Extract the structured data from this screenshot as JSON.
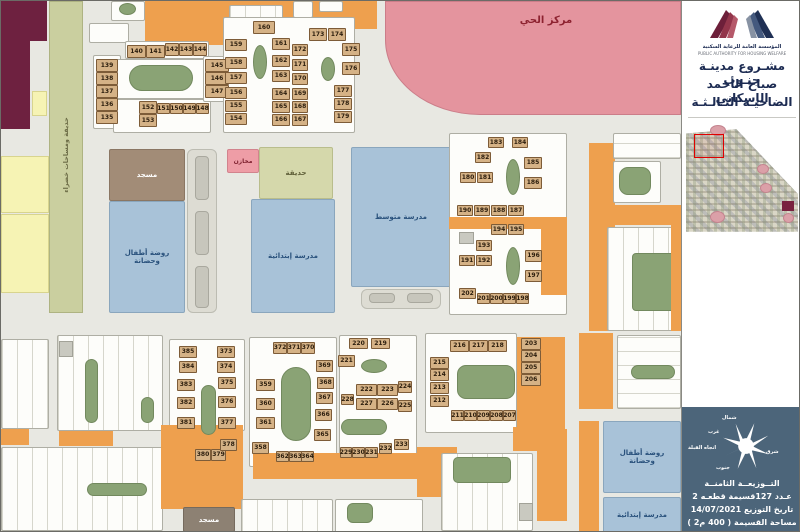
{
  "sidebar": {
    "org_name_ar": "المؤسسة العامة للرعاية السكنية",
    "org_name_en": "PUBLIC AUTHORITY FOR HOUSING WELFARE",
    "title_line1": "مشـروع مدينـة جنـوب",
    "title_line2": "صباح الأحمد الإسكاني",
    "title_line3": "الضاحيـة الثـالـثـة",
    "compass": {
      "north": "شمال",
      "west": "غرب",
      "east": "شرق",
      "south": "جنوب",
      "qibla": "اتجاه القبلة"
    },
    "info_lines": [
      "التــوزيعــة الثامنــة",
      "عـدد 127قسيمة قطعـه 2",
      "تاريخ التوزيع 14/07/2021",
      "مساحة القسيمة ( 400 م2 )"
    ]
  },
  "map": {
    "labels": {
      "neighborhood_center": "مركز الحي",
      "mosque": "مسجد",
      "kindergarten": "روضة أطفال وحضانة",
      "elementary_school": "مدرسة إبتدائية",
      "middle_school": "مدرسة متوسط",
      "stores": "مخازن",
      "park": "حديقة",
      "green_spaces": "حديقة ومساحات خضراء"
    },
    "plots": [
      [
        139,
        95,
        58,
        22,
        13
      ],
      [
        138,
        95,
        71,
        22,
        13
      ],
      [
        137,
        95,
        84,
        22,
        13
      ],
      [
        136,
        95,
        97,
        22,
        13
      ],
      [
        135,
        95,
        110,
        22,
        13
      ],
      [
        140,
        126,
        44,
        19,
        13
      ],
      [
        141,
        145,
        44,
        19,
        13
      ],
      [
        142,
        164,
        42,
        14,
        13
      ],
      [
        143,
        178,
        42,
        14,
        13
      ],
      [
        144,
        192,
        42,
        14,
        13
      ],
      [
        145,
        204,
        58,
        24,
        13
      ],
      [
        146,
        204,
        71,
        24,
        13
      ],
      [
        147,
        204,
        84,
        24,
        13
      ],
      [
        152,
        138,
        100,
        18,
        13
      ],
      [
        151,
        156,
        102,
        13,
        11
      ],
      [
        150,
        169,
        102,
        13,
        11
      ],
      [
        149,
        182,
        102,
        13,
        11
      ],
      [
        148,
        195,
        102,
        13,
        11
      ],
      [
        153,
        138,
        113,
        18,
        13
      ],
      [
        160,
        252,
        20,
        22,
        13
      ],
      [
        159,
        224,
        38,
        22,
        12
      ],
      [
        158,
        224,
        56,
        22,
        12
      ],
      [
        157,
        224,
        71,
        22,
        12
      ],
      [
        156,
        224,
        86,
        22,
        12
      ],
      [
        155,
        224,
        99,
        22,
        12
      ],
      [
        154,
        224,
        112,
        22,
        12
      ],
      [
        161,
        271,
        37,
        18,
        12
      ],
      [
        162,
        271,
        54,
        18,
        12
      ],
      [
        163,
        271,
        69,
        18,
        12
      ],
      [
        164,
        271,
        87,
        18,
        12
      ],
      [
        165,
        271,
        100,
        18,
        12
      ],
      [
        166,
        271,
        113,
        18,
        12
      ],
      [
        172,
        291,
        43,
        16,
        12
      ],
      [
        171,
        291,
        58,
        16,
        12
      ],
      [
        170,
        291,
        72,
        16,
        12
      ],
      [
        169,
        291,
        87,
        16,
        12
      ],
      [
        168,
        291,
        100,
        16,
        12
      ],
      [
        167,
        291,
        113,
        16,
        12
      ],
      [
        173,
        308,
        27,
        18,
        13
      ],
      [
        174,
        327,
        27,
        18,
        13
      ],
      [
        175,
        341,
        42,
        18,
        13
      ],
      [
        176,
        341,
        61,
        18,
        13
      ],
      [
        177,
        333,
        84,
        18,
        12
      ],
      [
        178,
        333,
        97,
        18,
        12
      ],
      [
        179,
        333,
        110,
        18,
        12
      ],
      [
        183,
        487,
        136,
        16,
        11
      ],
      [
        184,
        511,
        136,
        16,
        11
      ],
      [
        182,
        474,
        151,
        16,
        11
      ],
      [
        185,
        523,
        156,
        18,
        12
      ],
      [
        186,
        523,
        176,
        18,
        12
      ],
      [
        180,
        459,
        171,
        16,
        11
      ],
      [
        181,
        476,
        171,
        16,
        11
      ],
      [
        190,
        456,
        204,
        16,
        11
      ],
      [
        189,
        473,
        204,
        16,
        11
      ],
      [
        188,
        490,
        204,
        16,
        11
      ],
      [
        187,
        507,
        204,
        16,
        11
      ],
      [
        194,
        490,
        223,
        16,
        11
      ],
      [
        195,
        507,
        223,
        16,
        11
      ],
      [
        193,
        475,
        239,
        16,
        11
      ],
      [
        191,
        458,
        254,
        16,
        11
      ],
      [
        192,
        475,
        254,
        16,
        11
      ],
      [
        196,
        524,
        249,
        17,
        12
      ],
      [
        197,
        524,
        269,
        17,
        12
      ],
      [
        202,
        458,
        287,
        17,
        11
      ],
      [
        201,
        476,
        292,
        13,
        11
      ],
      [
        200,
        489,
        292,
        13,
        11
      ],
      [
        199,
        502,
        292,
        13,
        11
      ],
      [
        198,
        515,
        292,
        13,
        11
      ],
      [
        203,
        520,
        337,
        20,
        12
      ],
      [
        204,
        520,
        349,
        20,
        12
      ],
      [
        205,
        520,
        361,
        20,
        12
      ],
      [
        206,
        520,
        373,
        20,
        12
      ],
      [
        216,
        449,
        339,
        19,
        12
      ],
      [
        217,
        468,
        339,
        19,
        12
      ],
      [
        218,
        487,
        339,
        19,
        12
      ],
      [
        215,
        429,
        356,
        19,
        12
      ],
      [
        214,
        429,
        368,
        19,
        12
      ],
      [
        213,
        429,
        381,
        19,
        12
      ],
      [
        212,
        429,
        394,
        19,
        12
      ],
      [
        211,
        450,
        409,
        13,
        11
      ],
      [
        210,
        463,
        409,
        13,
        11
      ],
      [
        209,
        476,
        409,
        13,
        11
      ],
      [
        208,
        489,
        409,
        13,
        11
      ],
      [
        207,
        502,
        409,
        13,
        11
      ],
      [
        220,
        348,
        337,
        19,
        11
      ],
      [
        219,
        370,
        337,
        19,
        11
      ],
      [
        221,
        337,
        354,
        17,
        12
      ],
      [
        222,
        355,
        383,
        21,
        12
      ],
      [
        223,
        376,
        383,
        21,
        12
      ],
      [
        224,
        397,
        380,
        14,
        12
      ],
      [
        228,
        340,
        393,
        13,
        11
      ],
      [
        227,
        355,
        397,
        21,
        12
      ],
      [
        226,
        376,
        397,
        21,
        12
      ],
      [
        225,
        397,
        399,
        14,
        12
      ],
      [
        229,
        339,
        446,
        12,
        11
      ],
      [
        230,
        351,
        446,
        13,
        11
      ],
      [
        231,
        364,
        446,
        13,
        11
      ],
      [
        232,
        378,
        442,
        13,
        11
      ],
      [
        233,
        393,
        438,
        15,
        11
      ],
      [
        372,
        272,
        341,
        14,
        12
      ],
      [
        371,
        286,
        341,
        14,
        12
      ],
      [
        370,
        300,
        341,
        14,
        12
      ],
      [
        369,
        315,
        359,
        17,
        12
      ],
      [
        368,
        316,
        376,
        17,
        12
      ],
      [
        367,
        315,
        391,
        17,
        12
      ],
      [
        366,
        314,
        408,
        17,
        12
      ],
      [
        365,
        313,
        428,
        17,
        12
      ],
      [
        359,
        255,
        378,
        19,
        12
      ],
      [
        360,
        255,
        397,
        19,
        12
      ],
      [
        361,
        255,
        416,
        19,
        12
      ],
      [
        358,
        251,
        441,
        17,
        12
      ],
      [
        362,
        275,
        450,
        13,
        11
      ],
      [
        363,
        288,
        450,
        13,
        11
      ],
      [
        364,
        300,
        450,
        13,
        11
      ],
      [
        385,
        178,
        345,
        18,
        12
      ],
      [
        384,
        178,
        360,
        18,
        12
      ],
      [
        383,
        176,
        378,
        18,
        12
      ],
      [
        382,
        176,
        396,
        18,
        12
      ],
      [
        381,
        176,
        416,
        18,
        12
      ],
      [
        380,
        194,
        448,
        16,
        12
      ],
      [
        379,
        210,
        448,
        15,
        12
      ],
      [
        373,
        216,
        345,
        18,
        12
      ],
      [
        374,
        216,
        360,
        18,
        12
      ],
      [
        375,
        217,
        376,
        18,
        12
      ],
      [
        376,
        217,
        395,
        18,
        12
      ],
      [
        377,
        217,
        416,
        18,
        12
      ],
      [
        378,
        219,
        438,
        17,
        12
      ]
    ]
  },
  "colors": {
    "plot_fill": "#d5b286",
    "commercial_orange": "#eea04e",
    "park_green": "#8aa375",
    "center_pink": "#e4949e",
    "school_blue": "#a8c2d8",
    "panel_slate": "#4c657a",
    "title_navy": "#1c2b52",
    "maroon": "#6e2140",
    "yellow": "#f6f3b4"
  }
}
